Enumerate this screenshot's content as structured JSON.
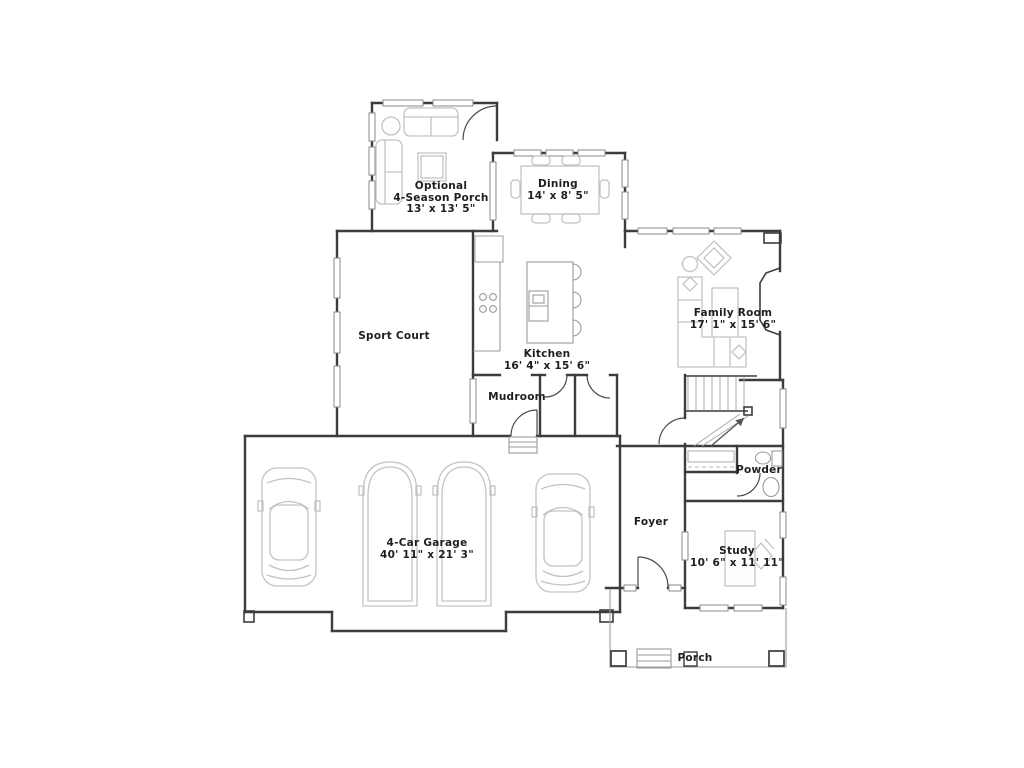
{
  "floor_plan": {
    "rooms": {
      "season_porch": {
        "line1": "Optional",
        "line2": "4-Season Porch",
        "dims": "13' x 13' 5\""
      },
      "dining": {
        "name": "Dining",
        "dims": "14' x 8' 5\""
      },
      "sport_court": {
        "name": "Sport Court"
      },
      "kitchen": {
        "name": "Kitchen",
        "dims": "16' 4\" x 15' 6\""
      },
      "family_room": {
        "name": "Family Room",
        "dims": "17' 1\" x 15' 6\""
      },
      "mudroom": {
        "name": "Mudroom"
      },
      "powder": {
        "name": "Powder"
      },
      "foyer": {
        "name": "Foyer"
      },
      "study": {
        "name": "Study",
        "dims": "10' 6\" x 11' 11\""
      },
      "garage": {
        "name": "4-Car Garage",
        "dims": "40' 11\" x 21' 3\""
      },
      "porch": {
        "name": "Porch"
      }
    },
    "colors": {
      "background": "#ffffff",
      "wall": "#3c3c3c",
      "furniture": "#b5b5b5",
      "text": "#1e1e1e"
    }
  }
}
